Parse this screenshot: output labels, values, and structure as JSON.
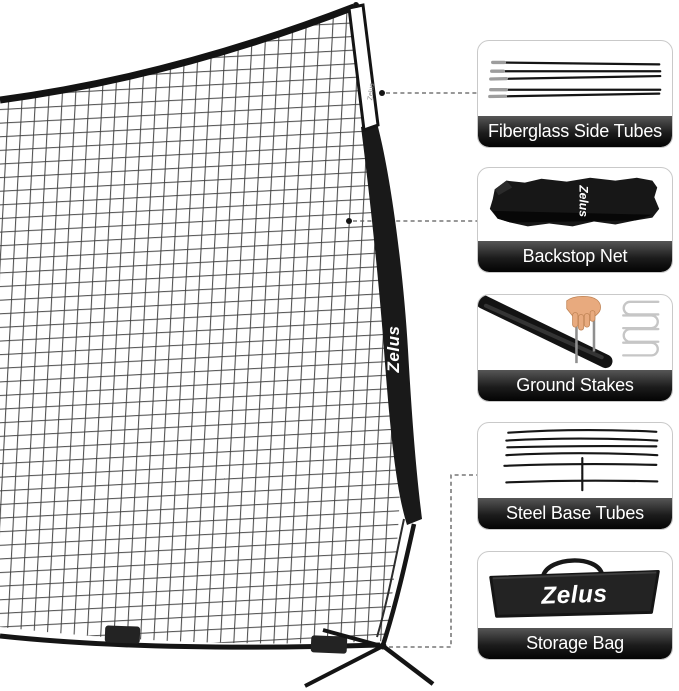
{
  "brand": "Zelus",
  "main_net": {
    "pole_brand_text": "Zelus",
    "pole_small_brand_text": "Zelus"
  },
  "callouts": [
    {
      "label": "Fiberglass Side Tubes",
      "icon": "fiberglass-rods-icon"
    },
    {
      "label": "Backstop Net",
      "icon": "rolled-net-icon",
      "brand_text": "Zelus"
    },
    {
      "label": "Ground Stakes",
      "icon": "ground-stakes-icon"
    },
    {
      "label": "Steel Base Tubes",
      "icon": "steel-tubes-icon"
    },
    {
      "label": "Storage Bag",
      "icon": "storage-bag-icon",
      "brand_text": "Zelus"
    }
  ],
  "colors": {
    "frame_black": "#161616",
    "mesh_line": "#303030",
    "card_border": "#c9c9c9",
    "label_gradient_top": "#565656",
    "label_gradient_bottom": "#030303",
    "connector_dash": "#5a5a5a",
    "hand_skin": "#e8aa7e",
    "stake_light": "#c6c6c6",
    "brand_text_color": "#ffffff"
  }
}
